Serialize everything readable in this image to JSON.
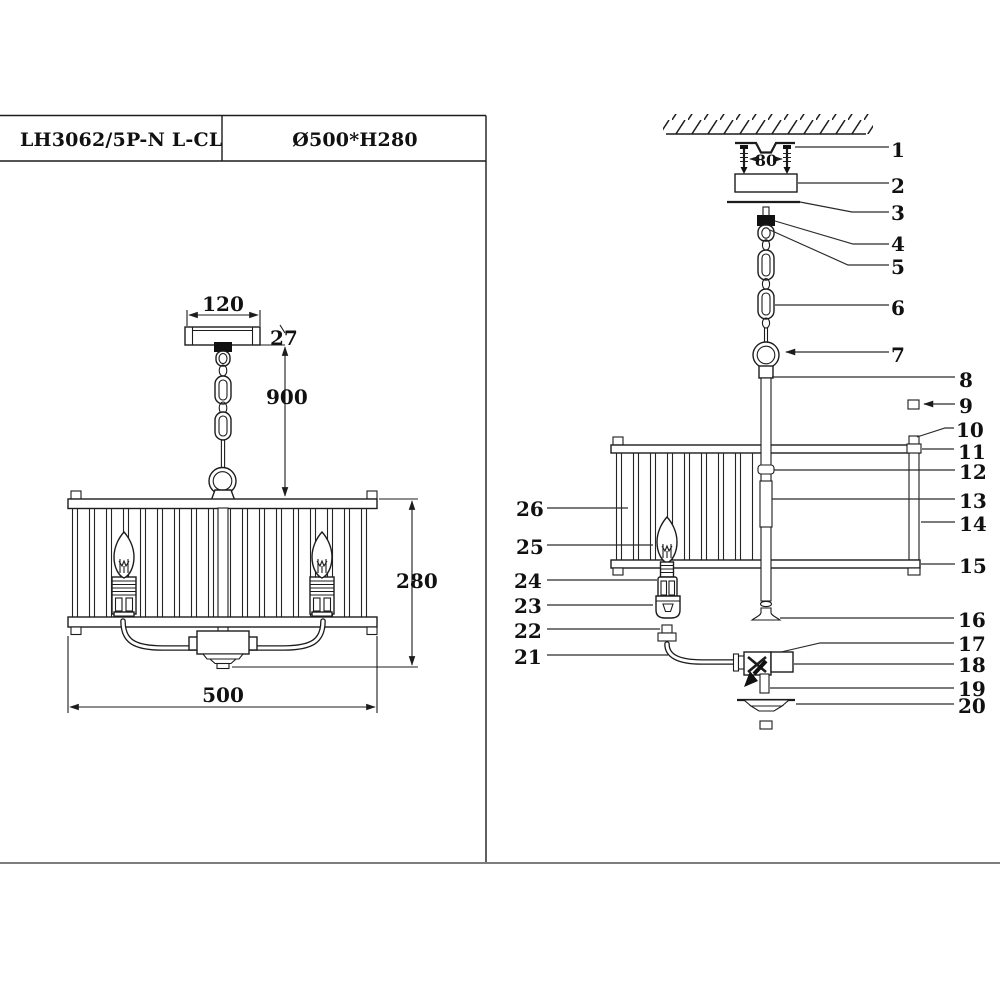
{
  "title_block": {
    "model": "LH3062/5P-N L-CL",
    "size_spec": "Ø500*H280"
  },
  "front_view": {
    "dims": {
      "canopy_width": "120",
      "canopy_height": "27",
      "suspension_height": "900",
      "shade_height": "280",
      "shade_diameter": "500"
    }
  },
  "exploded_view": {
    "dims": {
      "mount_hole_spacing": "80"
    },
    "callouts": [
      "1",
      "2",
      "3",
      "4",
      "5",
      "6",
      "7",
      "8",
      "9",
      "10",
      "11",
      "12",
      "13",
      "14",
      "15",
      "16",
      "17",
      "18",
      "19",
      "20",
      "21",
      "22",
      "23",
      "24",
      "25",
      "26"
    ]
  }
}
